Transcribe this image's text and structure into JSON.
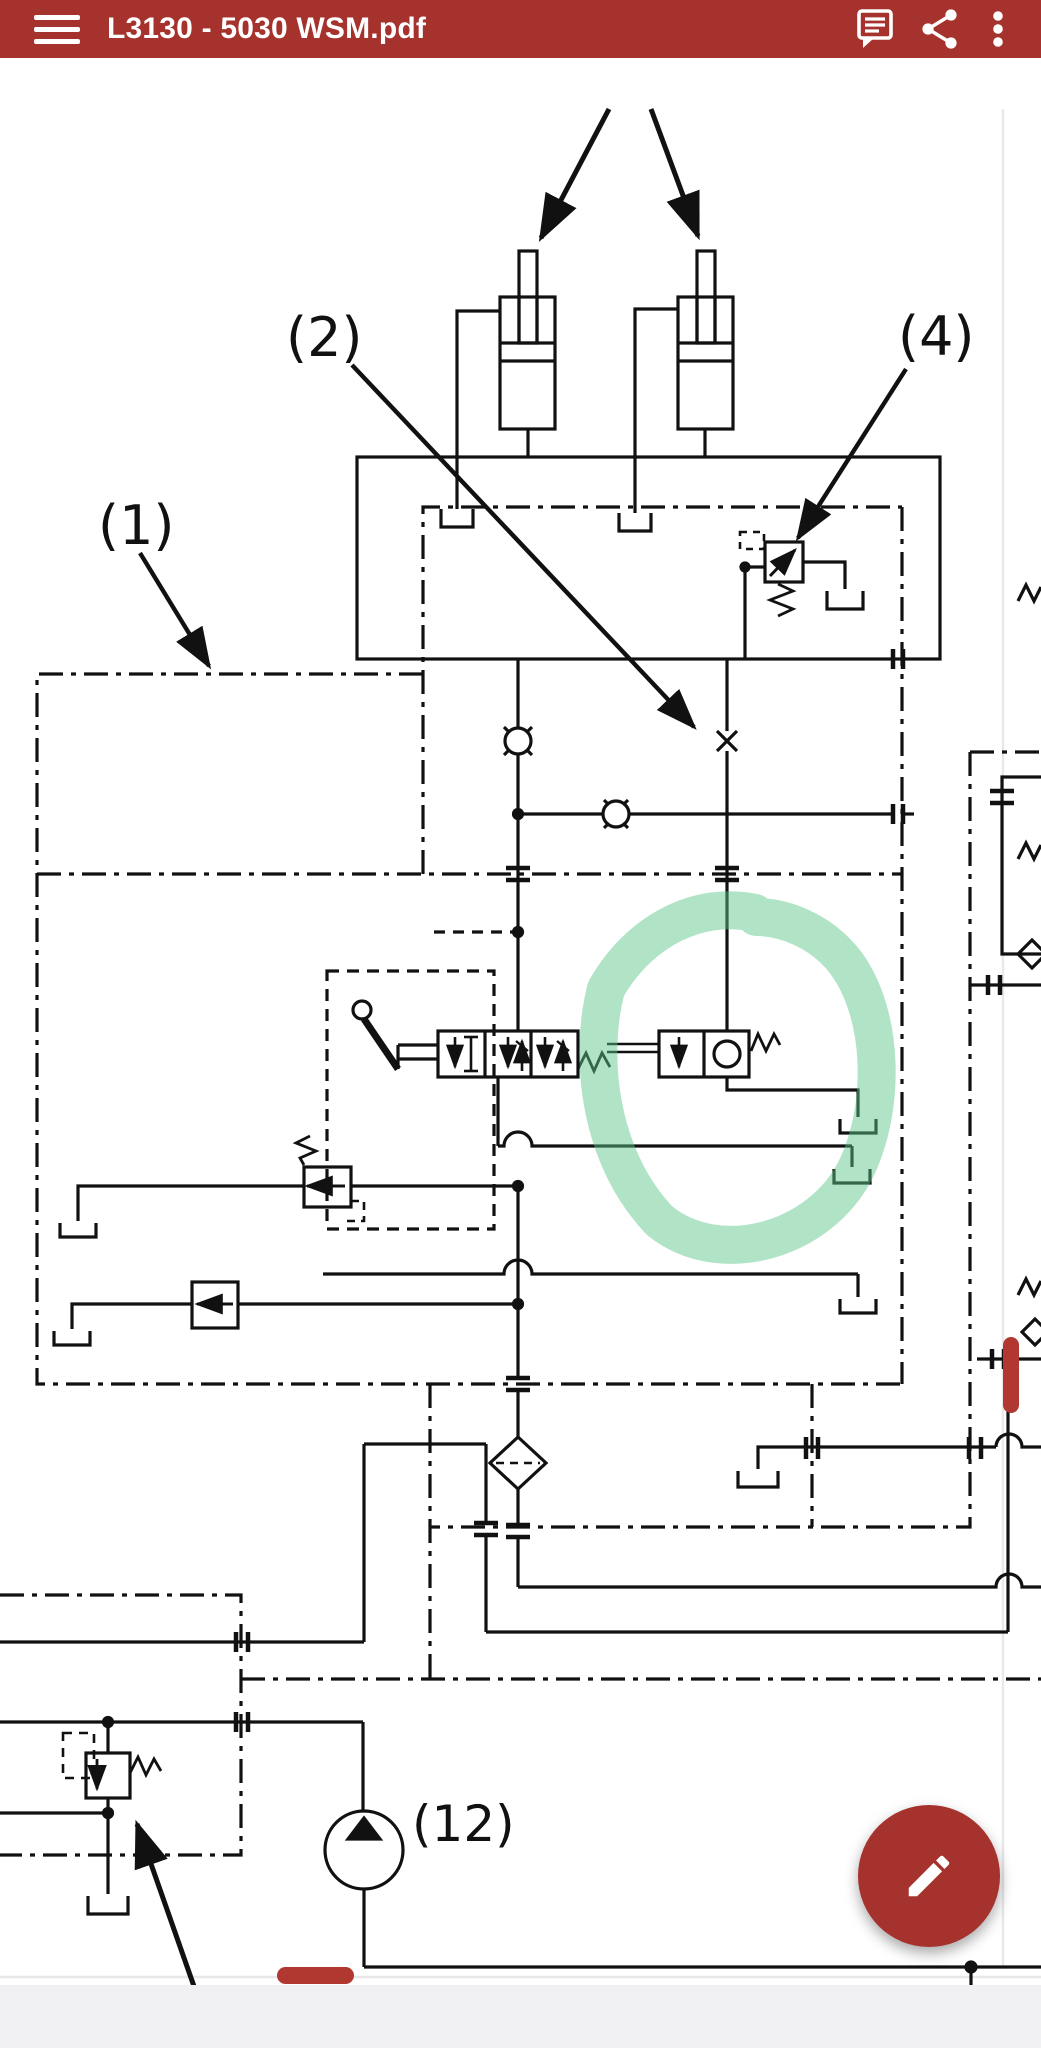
{
  "app_bar": {
    "title": "L3130 - 5030 WSM.pdf",
    "menu_icon": "hamburger-menu-icon",
    "actions": [
      {
        "icon": "annotations-icon"
      },
      {
        "icon": "share-icon"
      },
      {
        "icon": "overflow-menu-icon"
      }
    ]
  },
  "document": {
    "type": "hydraulic-circuit-schematic",
    "labels": {
      "l1": "(1)",
      "l2": "(2)",
      "l4": "(4)",
      "l12": "(12)"
    },
    "annotations": {
      "green_highlight": "hand-drawn highlighter circle around check valve block",
      "red_mark_vertical": "short red bar on right-side line",
      "red_mark_horizontal": "short red bar near page bottom"
    }
  },
  "fab": {
    "icon": "pencil-edit-icon"
  },
  "navigation": {
    "gesture_pill": true
  },
  "colors": {
    "app_bar": "#a5322c",
    "fab": "#a5322c",
    "highlight_green": "rgba(92,199,138,0.48)",
    "annotation_red": "#b13831",
    "nav_pill": "#6b6b6b",
    "bottom_strip": "#f0f0f2",
    "line": "#111111"
  }
}
